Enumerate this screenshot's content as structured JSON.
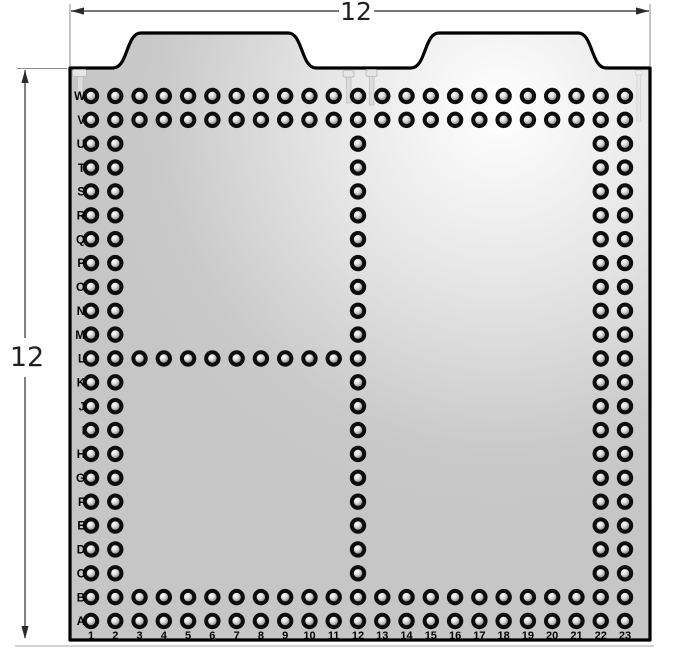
{
  "diagram": {
    "type": "pegboard-panel-drawing",
    "dimensions": {
      "top_label": "12",
      "left_label": "12"
    },
    "board": {
      "row_labels_top_to_bottom": [
        "W",
        "V",
        "U",
        "T",
        "S",
        "R",
        "Q",
        "P",
        "O",
        "N",
        "M",
        "L",
        "K",
        "J",
        "I",
        "H",
        "G",
        "F",
        "E",
        "D",
        "C",
        "B",
        "A"
      ],
      "column_labels": [
        "1",
        "2",
        "3",
        "4",
        "5",
        "6",
        "7",
        "8",
        "9",
        "10",
        "11",
        "12",
        "13",
        "14",
        "15",
        "16",
        "17",
        "18",
        "19",
        "20",
        "21",
        "22",
        "23"
      ],
      "hole_pattern": {
        "full_rows": [
          "W",
          "V",
          "B",
          "A"
        ],
        "full_columns": [
          1,
          2,
          12,
          22,
          23
        ],
        "partial_rows": {
          "L": [
            3,
            4,
            5,
            6,
            7,
            8,
            9,
            10,
            11
          ]
        }
      },
      "tab_count": 2
    },
    "icons": {
      "pin_mark": "nail-pin-icon",
      "pin_mark_count": 4
    },
    "colors": {
      "panel_fill": "#c6c6c6",
      "panel_highlight": "#ffffff",
      "panel_outline": "#000000",
      "hole_ring": "#0d0d0d",
      "hole_inner_dark": "#858585",
      "hole_inner_light": "#ffffff",
      "dimension_line": "#4a4a4a",
      "extension_line": "#8a8a8a",
      "label_color": "#000000",
      "pin_fill": "#e2e2e2",
      "pin_stroke": "#b5b5b5"
    }
  }
}
